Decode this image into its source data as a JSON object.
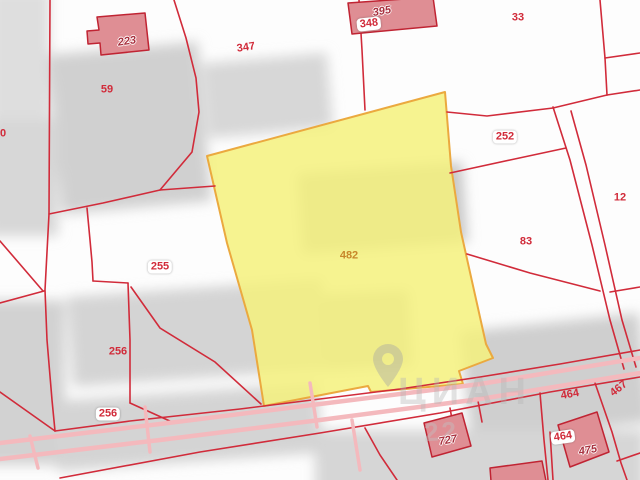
{
  "map": {
    "selected_parcel": "482",
    "watermark": {
      "text": "ЦИАН",
      "numbers": "22"
    },
    "colors": {
      "line-red": "#d12b3a",
      "building-fill": "#df8e94",
      "building-stroke": "#c02433",
      "selected-fill": "#f4f17c",
      "selected-stroke": "#eba93f",
      "selected-label": "#c8872a",
      "road-pink": "#f4b9bd",
      "footprint-gray": "#d0d0d0"
    },
    "labels": [
      {
        "text": "80",
        "x": 0,
        "y": 134,
        "kind": "plain",
        "rot": 0
      },
      {
        "text": "59",
        "x": 107,
        "y": 90,
        "kind": "plain",
        "rot": 0
      },
      {
        "text": "347",
        "x": 246,
        "y": 48,
        "kind": "plain",
        "rot": -8
      },
      {
        "text": "33",
        "x": 518,
        "y": 18,
        "kind": "plain",
        "rot": 0
      },
      {
        "text": "252",
        "x": 505,
        "y": 137,
        "kind": "halo",
        "rot": 0
      },
      {
        "text": "12",
        "x": 620,
        "y": 198,
        "kind": "plain",
        "rot": 0
      },
      {
        "text": "83",
        "x": 526,
        "y": 242,
        "kind": "plain",
        "rot": 0
      },
      {
        "text": "255",
        "x": 160,
        "y": 267,
        "kind": "halo",
        "rot": 0
      },
      {
        "text": "482",
        "x": 349,
        "y": 256,
        "kind": "orange",
        "rot": 0
      },
      {
        "text": "256",
        "x": 118,
        "y": 352,
        "kind": "plain",
        "rot": 0
      },
      {
        "text": "256",
        "x": 108,
        "y": 414,
        "kind": "halo",
        "rot": 0
      },
      {
        "text": "464",
        "x": 570,
        "y": 395,
        "kind": "plain",
        "rot": -10
      },
      {
        "text": "467",
        "x": 619,
        "y": 389,
        "kind": "plain",
        "rot": -38
      },
      {
        "text": "464",
        "x": 563,
        "y": 437,
        "kind": "halo",
        "rot": -8
      },
      {
        "text": "223",
        "x": 127,
        "y": 42,
        "kind": "bld",
        "rot": -8
      },
      {
        "text": "395",
        "x": 382,
        "y": 12,
        "kind": "bld",
        "rot": -10
      },
      {
        "text": "348",
        "x": 369,
        "y": 24,
        "kind": "halo",
        "rot": -6
      },
      {
        "text": "727",
        "x": 448,
        "y": 441,
        "kind": "bld",
        "rot": -10
      },
      {
        "text": "475",
        "x": 588,
        "y": 451,
        "kind": "bld",
        "rot": -10
      }
    ]
  }
}
